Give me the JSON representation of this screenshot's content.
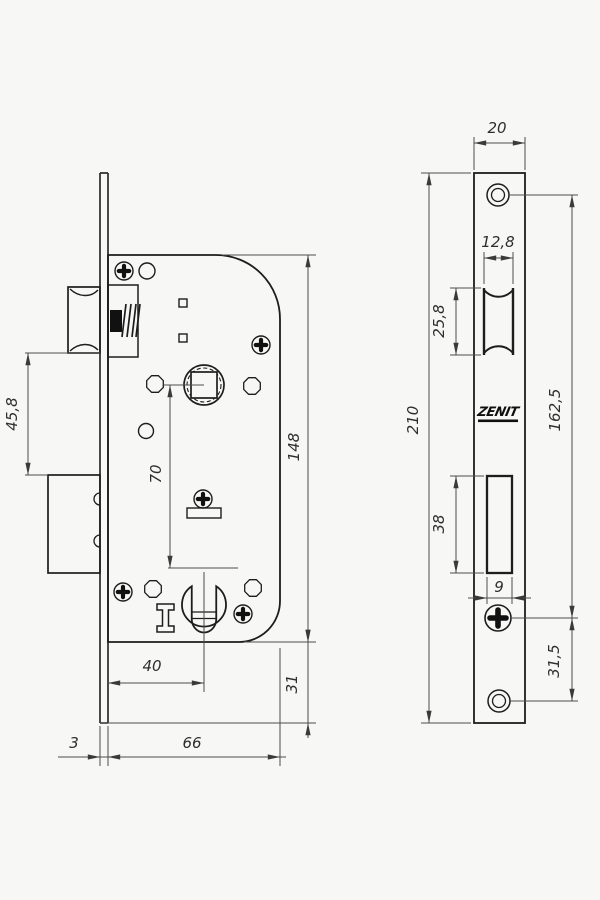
{
  "title": "Mortise lock technical drawing",
  "logo": {
    "text": "ZENIT"
  },
  "colors": {
    "outline": "#1d1d1d",
    "dimension": "#4d4d4d",
    "background": "#f7f7f6"
  },
  "left_view": {
    "label": "lock body side view",
    "dims": {
      "latch_to_deadbolt": "45,8",
      "hub_to_cylinder": "70",
      "body_height": "148",
      "backset": "40",
      "bottom_margin": "31",
      "faceplate_thickness": "3",
      "body_depth": "66"
    }
  },
  "right_view": {
    "label": "faceplate front view",
    "dims": {
      "faceplate_width": "20",
      "latch_opening_width": "12,8",
      "latch_opening_height": "25,8",
      "faceplate_height": "210",
      "hole_span": "162,5",
      "deadbolt_opening_height": "38",
      "deadbolt_opening_width": "9",
      "screw_to_hole": "31,5"
    }
  }
}
